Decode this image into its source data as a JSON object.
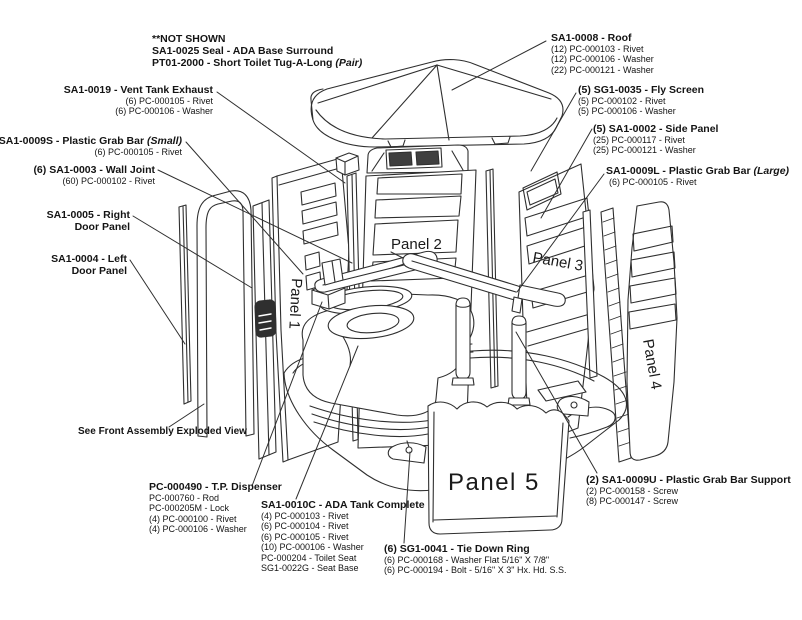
{
  "page": {
    "background": "#ffffff",
    "line_color": "#2f2f2f"
  },
  "panel_labels": {
    "p1": "Panel 1",
    "p2": "Panel 2",
    "p3": "Panel 3",
    "p4": "Panel 4",
    "p5": "Panel 5"
  },
  "callouts": {
    "not_shown": {
      "line1": "**NOT SHOWN",
      "line2": "SA1-0025 Seal - ADA  Base Surround",
      "line3": "PT01-2000 - Short Toilet Tug-A-Long ",
      "line3_em": "(Pair)"
    },
    "vent": {
      "title": "SA1-0019 - Vent Tank Exhaust",
      "subs": [
        "(6) PC-000105 - Rivet",
        "(6) PC-000106 - Washer"
      ]
    },
    "grab_small": {
      "title": "SA1-0009S - Plastic Grab Bar ",
      "title_em": "(Small)",
      "subs": [
        "(6) PC-000105 - Rivet"
      ]
    },
    "wall_joint": {
      "title": "(6) SA1-0003 - Wall Joint",
      "subs": [
        "(60) PC-000102 - Rivet"
      ]
    },
    "right_door": {
      "title": "SA1-0005 - Right",
      "title2": "Door Panel"
    },
    "left_door": {
      "title": "SA1-0004 - Left",
      "title2": "Door Panel"
    },
    "see_front": {
      "title": "See Front Assembly Exploded View"
    },
    "roof": {
      "title": "SA1-0008 - Roof",
      "subs": [
        "(12) PC-000103 - Rivet",
        "(12) PC-000106 - Washer",
        "(22) PC-000121 - Washer"
      ]
    },
    "fly_screen": {
      "title": "(5) SG1-0035 - Fly Screen",
      "subs": [
        "(5) PC-000102 - Rivet",
        "(5) PC-000106 - Washer"
      ]
    },
    "side_panel": {
      "title": "(5) SA1-0002 - Side Panel",
      "subs": [
        "(25) PC-000117 - Rivet",
        "(25) PC-000121 - Washer"
      ]
    },
    "grab_large": {
      "title": "SA1-0009L - Plastic Grab Bar ",
      "title_em": "(Large)",
      "subs": [
        "(6) PC-000105 - Rivet"
      ]
    },
    "tp_dispenser": {
      "title": "PC-000490 - T.P. Dispenser",
      "subs": [
        "PC-000760 - Rod",
        "PC-000205M - Lock",
        "(4) PC-000100 - Rivet",
        "(4) PC-000106 - Washer"
      ]
    },
    "ada_tank": {
      "title": "SA1-0010C - ADA Tank Complete",
      "subs": [
        "(4) PC-000103 - Rivet",
        "(6) PC-000104 - Rivet",
        "(6) PC-000105 - Rivet",
        "(10) PC-000106 - Washer",
        "PC-000204 - Toilet Seat",
        "SG1-0022G - Seat Base"
      ]
    },
    "tie_down": {
      "title": "(6) SG1-0041 - Tie Down Ring",
      "subs": [
        "(6) PC-000168 - Washer Flat 5/16\" X 7/8\"",
        "(6) PC-000194 - Bolt - 5/16\" X 3\" Hx. Hd. S.S."
      ]
    },
    "grab_support": {
      "title": "(2) SA1-0009U - Plastic Grab Bar Support",
      "subs": [
        "(2) PC-000158 - Screw",
        "(8) PC-000147 - Screw"
      ]
    }
  }
}
